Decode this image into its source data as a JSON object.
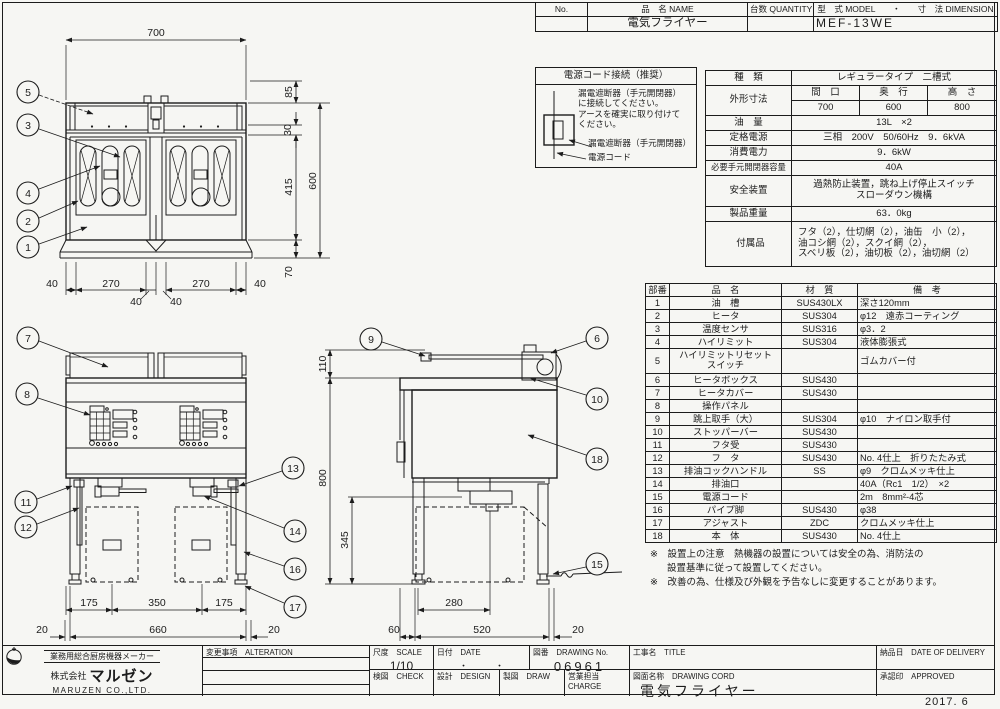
{
  "top_table": {
    "no_label": "No.",
    "name_label": "品　名 NAME",
    "qty_label": "台数 QUANTITY",
    "model_dim_label": "型　式 MODEL　　・　　寸　法 DIMENSION",
    "name_value": "電気フライヤー",
    "model_value": "MEF-13WE"
  },
  "power_box": {
    "title": "電源コード接続（推奨）",
    "instruction": "漏電遮断器（手元開閉器）\nに接続してください。\nアースを確実に取り付けて\nください。",
    "label_breaker": "漏電遮断器（手元開閉器）",
    "label_cord": "電源コード"
  },
  "spec": {
    "kind_label": "種　類",
    "kind_value": "レギュラータイプ　二槽式",
    "outer_label": "外形寸法",
    "w_label": "間　口",
    "d_label": "奥　行",
    "h_label": "高　さ",
    "w": "700",
    "d": "600",
    "h": "800",
    "oil_label": "油　量",
    "oil_value": "13L　×2",
    "power_label": "定格電源",
    "power_value": "三相　200V　50/60Hz　9．6kVA",
    "consumption_label": "消費電力",
    "consumption_value": "9．6kW",
    "breaker_label": "必要手元開閉器容量",
    "breaker_value": "40A",
    "safety_label": "安全装置",
    "safety_value1": "過熱防止装置，跳ね上げ停止スイッチ",
    "safety_value2": "スローダウン機構",
    "weight_label": "製品重量",
    "weight_value": "63．0kg",
    "acc_label": "付属品",
    "acc_value1": "フタ（2），仕切網（2），油缶　小（2），",
    "acc_value2": "油コシ網（2），スクイ網（2），",
    "acc_value3": "スベリ板（2），油切板（2），油切網（2）"
  },
  "parts": {
    "h_no": "部番",
    "h_name": "品　名",
    "h_mat": "材　質",
    "h_note": "備　考",
    "rows": [
      {
        "no": "1",
        "name": "油　槽",
        "mat": "SUS430LX",
        "note": "深さ120mm"
      },
      {
        "no": "2",
        "name": "ヒータ",
        "mat": "SUS304",
        "note": "φ12　遠赤コーティング"
      },
      {
        "no": "3",
        "name": "温度センサ",
        "mat": "SUS316",
        "note": "φ3．2"
      },
      {
        "no": "4",
        "name": "ハイリミット",
        "mat": "SUS304",
        "note": "液体膨張式"
      },
      {
        "no": "5",
        "name": "ハイリミットリセット\nスイッチ",
        "mat": "",
        "note": "ゴムカバー付"
      },
      {
        "no": "6",
        "name": "ヒータボックス",
        "mat": "SUS430",
        "note": ""
      },
      {
        "no": "7",
        "name": "ヒータカバー",
        "mat": "SUS430",
        "note": ""
      },
      {
        "no": "8",
        "name": "操作パネル",
        "mat": "",
        "note": ""
      },
      {
        "no": "9",
        "name": "跳上取手（大）",
        "mat": "SUS304",
        "note": "φ10　ナイロン取手付"
      },
      {
        "no": "10",
        "name": "ストッパーバー",
        "mat": "SUS430",
        "note": ""
      },
      {
        "no": "11",
        "name": "フタ受",
        "mat": "SUS430",
        "note": ""
      },
      {
        "no": "12",
        "name": "フ　タ",
        "mat": "SUS430",
        "note": "No. 4仕上　折りたたみ式"
      },
      {
        "no": "13",
        "name": "排油コックハンドル",
        "mat": "SS",
        "note": "φ9　クロムメッキ仕上"
      },
      {
        "no": "14",
        "name": "排油口",
        "mat": "",
        "note": "40A（Rc1　1/2）　×2"
      },
      {
        "no": "15",
        "name": "電源コード",
        "mat": "",
        "note": "2m　8mm²-4芯"
      },
      {
        "no": "16",
        "name": "パイプ脚",
        "mat": "SUS430",
        "note": "φ38"
      },
      {
        "no": "17",
        "name": "アジャスト",
        "mat": "ZDC",
        "note": "クロムメッキ仕上"
      },
      {
        "no": "18",
        "name": "本　体",
        "mat": "SUS430",
        "note": "No. 4仕上"
      }
    ]
  },
  "notes": {
    "l1": "※　設置上の注意　熱機器の設置については安全の為、消防法の",
    "l2": "設置基準に従って設置してください。",
    "l3": "※　改善の為、仕様及び外観を予告なしに変更することがあります。"
  },
  "footer": {
    "maker_tagline": "業務用総合厨房機器メーカー",
    "company_prefix": "株式会社",
    "company_name": "マルゼン",
    "company_en": "MARUZEN  CO.,LTD.",
    "alteration_label": "変更事項　ALTERATION",
    "scale_label": "尺度　SCALE",
    "scale_value": "1/10",
    "date_label": "日付　DATE",
    "date_value": "・　　　・",
    "dwg_no_label": "図番　DRAWING No.",
    "dwg_no_value": "06961",
    "check_label": "検図　CHECK",
    "design_label": "設計　DESIGN",
    "draw_label": "製図　DRAW",
    "charge_label": "営業担当　CHARGE",
    "title_label": "工事名　TITLE",
    "dwg_name_label": "図面名称　DRAWING CORD",
    "dwg_name_value": "電気フライヤー",
    "delivery_label": "納品日　DATE OF DELIVERY",
    "approved_label": "承認印　APPROVED",
    "date_stamp": "2017. 6"
  },
  "dims": {
    "plan": {
      "w": "700",
      "rear": "85",
      "hinge": "30",
      "tank": "415",
      "depth": "600",
      "front": "70",
      "b40l": "40",
      "b270l": "270",
      "b40c1": "40",
      "b40c2": "40",
      "b270r": "270",
      "b40r": "40"
    },
    "front": {
      "d175l": "175",
      "d350": "350",
      "d175r": "175",
      "d20l": "20",
      "d660": "660",
      "d20r": "20"
    },
    "side": {
      "d110": "110",
      "d800": "800",
      "d345": "345",
      "d280": "280",
      "d60": "60",
      "d520": "520",
      "d20": "20"
    }
  },
  "callouts": {
    "c1": "1",
    "c2": "2",
    "c3": "3",
    "c4": "4",
    "c5": "5",
    "c6": "6",
    "c7": "7",
    "c8": "8",
    "c9": "9",
    "c10": "10",
    "c11": "11",
    "c12": "12",
    "c13": "13",
    "c14": "14",
    "c15": "15",
    "c16": "16",
    "c17": "17",
    "c18": "18"
  }
}
